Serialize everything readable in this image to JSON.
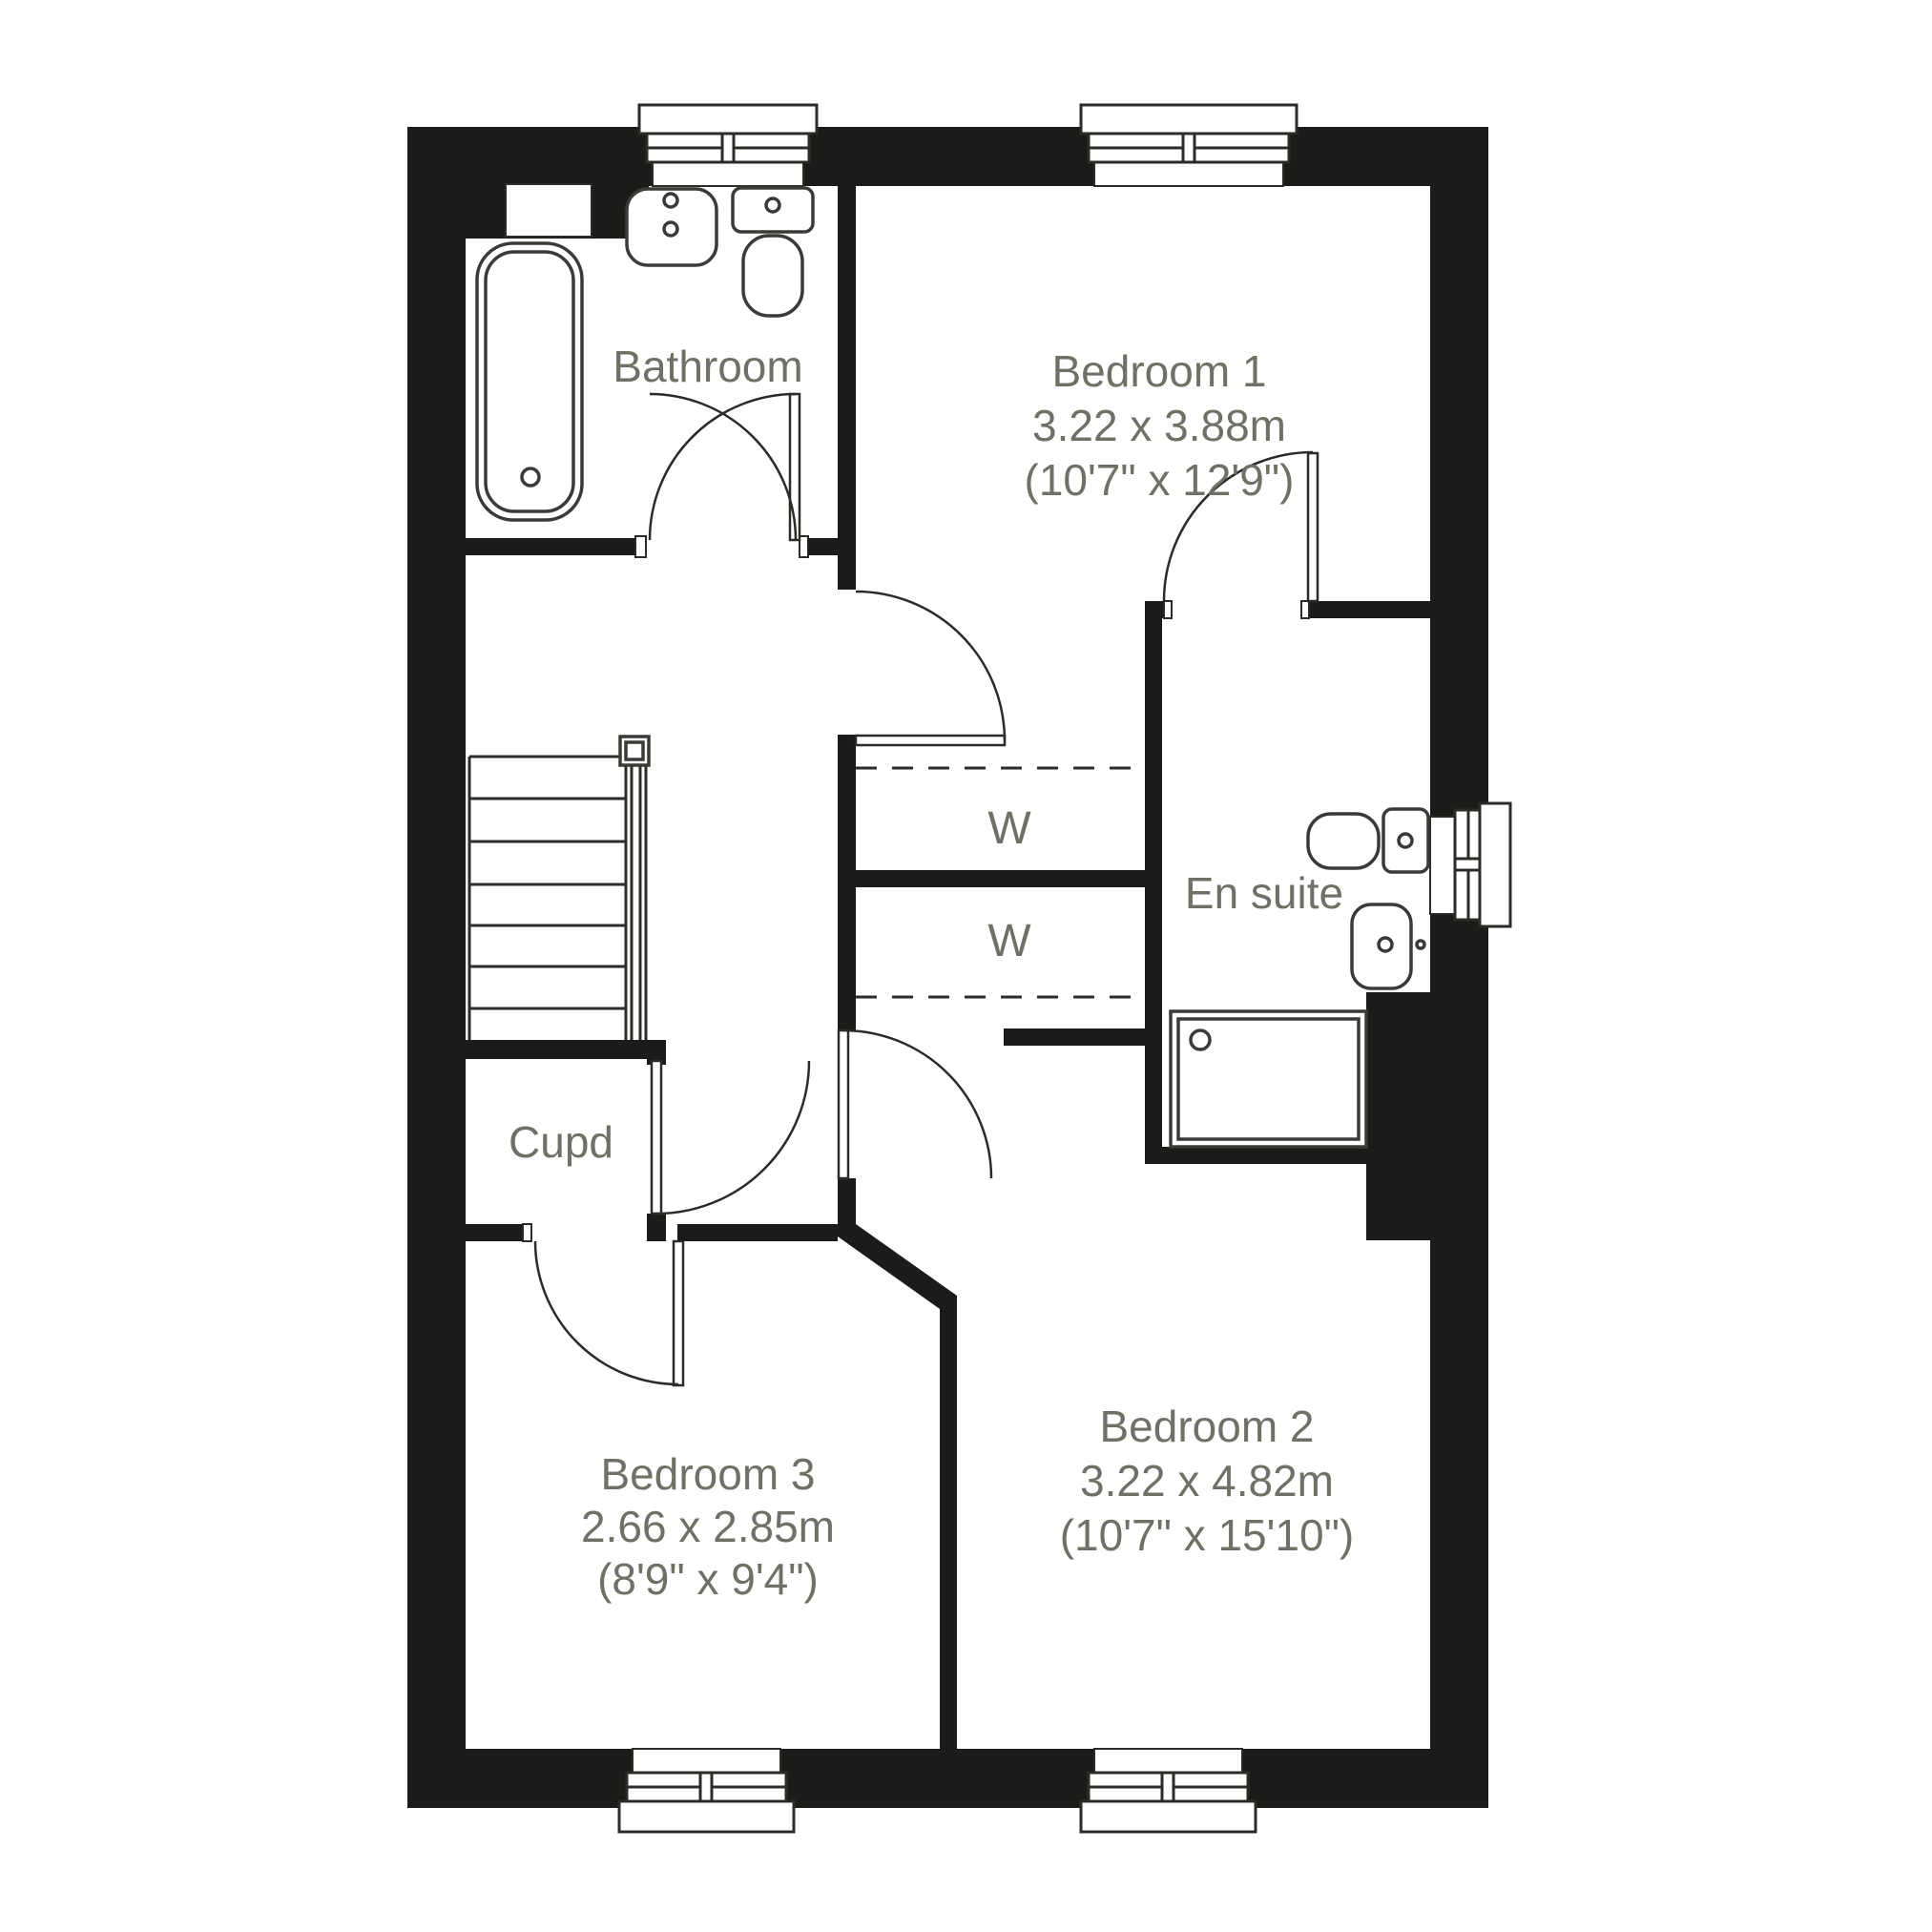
{
  "plan": {
    "type": "floorplan",
    "colors": {
      "wall": "#1d1b19",
      "line": "#2b2b28",
      "label_text": "#6e7166",
      "background": "#ffffff"
    },
    "rooms": [
      {
        "id": "bathroom",
        "label": "Bathroom"
      },
      {
        "id": "bedroom1",
        "label": "Bedroom 1",
        "size_metric": "3.22 x 3.88m",
        "size_imperial": "(10'7\" x 12'9\")"
      },
      {
        "id": "ensuite",
        "label": "En suite"
      },
      {
        "id": "cupboard",
        "label": "Cupd"
      },
      {
        "id": "bedroom3",
        "label": "Bedroom 3",
        "size_metric": "2.66 x 2.85m",
        "size_imperial": "(8'9\" x 9'4\")"
      },
      {
        "id": "bedroom2",
        "label": "Bedroom 2",
        "size_metric": "3.22 x 4.82m",
        "size_imperial": "(10'7\" x 15'10\")"
      }
    ],
    "wardrobes": [
      {
        "id": "wardrobe-1",
        "label": "W"
      },
      {
        "id": "wardrobe-2",
        "label": "W"
      }
    ],
    "fixtures": [
      "bath",
      "bathroom-sink",
      "bathroom-toilet",
      "ensuite-toilet",
      "ensuite-sink",
      "shower",
      "stairs"
    ],
    "window_count": 5,
    "door_count": 6
  }
}
